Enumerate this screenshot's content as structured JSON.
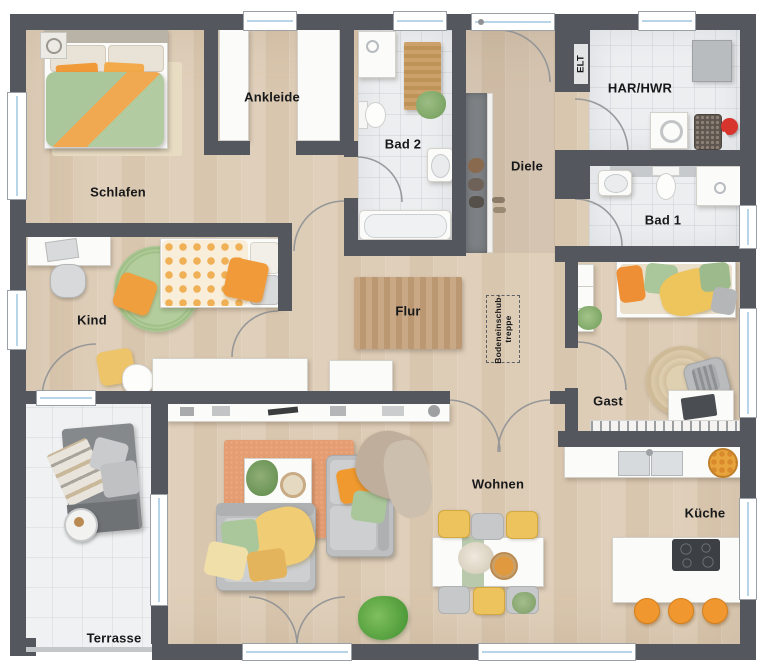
{
  "plan": {
    "title": "Erdgeschoss Grundriss Bungalow",
    "rooms": {
      "schlafen": {
        "label": "Schlafen"
      },
      "ankleide": {
        "label": "Ankleide"
      },
      "bad2": {
        "label": "Bad 2"
      },
      "diele": {
        "label": "Diele"
      },
      "elt": {
        "label": "ELT"
      },
      "har_hwr": {
        "label": "HAR/HWR"
      },
      "bad1": {
        "label": "Bad 1"
      },
      "kind": {
        "label": "Kind"
      },
      "flur": {
        "label": "Flur"
      },
      "bodeneinschubtreppe": {
        "label": "Bodeneinschub-\ntreppe"
      },
      "gast": {
        "label": "Gast"
      },
      "wohnen": {
        "label": "Wohnen"
      },
      "kueche": {
        "label": "Küche"
      },
      "terrasse": {
        "label": "Terrasse"
      }
    },
    "colors": {
      "wall": "#54575d",
      "wood": "#e0d0bb",
      "wood2": "#d9c6ae",
      "wood3": "#ddccb6",
      "tile": "#eceef0",
      "terr": "#eff1f2",
      "glass": "#b8d4e8",
      "orange": "#f09a3a",
      "green": "#a9c79b",
      "yellow": "#f0cc74",
      "rug_orange": "#e49d72",
      "red": "#d7342e"
    }
  }
}
